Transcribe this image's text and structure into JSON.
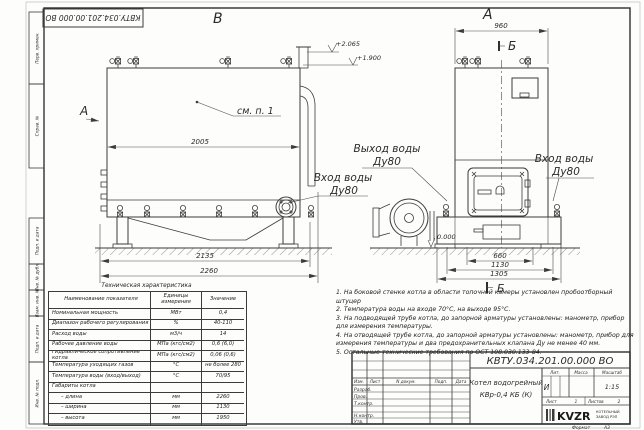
{
  "frame": {
    "stamp": "КВТУ.034.201.00.000 ВО",
    "side_labels": [
      "Перв. примен.",
      "Справ. №",
      "Подп. и дата",
      "Инв. № дубл.",
      "Взам. инв. №",
      "Подп. и дата",
      "Инв. № подл."
    ],
    "format_label": "Формат",
    "format_value": "А3"
  },
  "drawing": {
    "view_b_label": "В",
    "view_a_label": "А",
    "arrow_a_label": "А",
    "section_b_label": "Б",
    "section_b_title": "Б",
    "see_note": "см. п. 1",
    "dim_2005": "2005",
    "dim_2135": "2135",
    "dim_2260": "2260",
    "dim_960": "960",
    "dim_660": "660",
    "dim_1130": "1130",
    "dim_1305": "1305",
    "elev_1": "+2.065",
    "elev_2": "+1.900",
    "elev_0": "0.000",
    "inlet_left_1": "Вход воды",
    "inlet_left_2": "Ду80",
    "outlet_1": "Выход воды",
    "outlet_2": "Ду80",
    "inlet_right_1": "Вход воды",
    "inlet_right_2": "Ду80"
  },
  "table": {
    "title": "Техническая характеристика",
    "col_name": "Наименование показателя",
    "col_unit": "Единицы измерения",
    "col_value": "Значение",
    "rows": [
      {
        "name": "Номинальная мощность",
        "unit": "МВт",
        "value": "0,4"
      },
      {
        "name": "Диапазон рабочего регулирования",
        "unit": "%",
        "value": "40-110"
      },
      {
        "name": "Расход воды",
        "unit": "м3/ч",
        "value": "14"
      },
      {
        "name": "Рабочее давление воды",
        "unit": "МПа (кгс/см2)",
        "value": "0,6 (6,0)"
      },
      {
        "name": "Гидравлическое сопротивление котла",
        "unit": "МПа (кгс/см2)",
        "value": "0,06 (0,6)"
      },
      {
        "name": "Температура уходящих газов",
        "unit": "°С",
        "value": "не более 280"
      },
      {
        "name": "Температура воды (вход/выход)",
        "unit": "°С",
        "value": "70/95"
      },
      {
        "name": "Габариты котла",
        "unit": "",
        "value": ""
      },
      {
        "name": "– длина",
        "unit": "мм",
        "value": "2260"
      },
      {
        "name": "– ширина",
        "unit": "мм",
        "value": "1130"
      },
      {
        "name": "– высота",
        "unit": "мм",
        "value": "1950"
      }
    ]
  },
  "notes": [
    "1. На боковой стенке котла в области топочной камеры установлен пробоотборный штуцер",
    "2. Температура воды на входе 70°С, на выходе 95°С.",
    "3. На подводящей трубе котла, до запорной арматуры установлены: манометр, прибор для измерения температуры.",
    "4. На отводящей трубе котла, до запорной арматуры установлены: манометр, прибор для измерения температуры и два предохранительных клапана Ду не менее 40 мм.",
    "5. Остальные технические требования по ОСТ 108.030.133-84."
  ],
  "title_block": {
    "code": "КВТУ.034.201.00.000 ВО",
    "name_line1": "Котел водогрейный",
    "name_line2": "КВр-0,4  КБ  (К)",
    "col_izm": "Изм.",
    "col_list": "Лист",
    "col_doc": "N докум.",
    "col_sign": "Подп.",
    "col_date": "Дата",
    "row_labels": [
      "Разраб.",
      "Пров.",
      "Т.контр.",
      "Н.контр.",
      "Утв."
    ],
    "lit_label": "Лит.",
    "lit_value": "И",
    "mass_label": "Масса",
    "scale_label": "Масштаб",
    "scale_value": "1:15",
    "sheet_label": "Лист",
    "sheet_num": "1",
    "sheets_label": "Листов",
    "sheets_num": "2",
    "logo": "KVZR",
    "logo_sub1": "КОТЕЛЬНЫЙ",
    "logo_sub2": "ЗАВОД РЭП"
  }
}
